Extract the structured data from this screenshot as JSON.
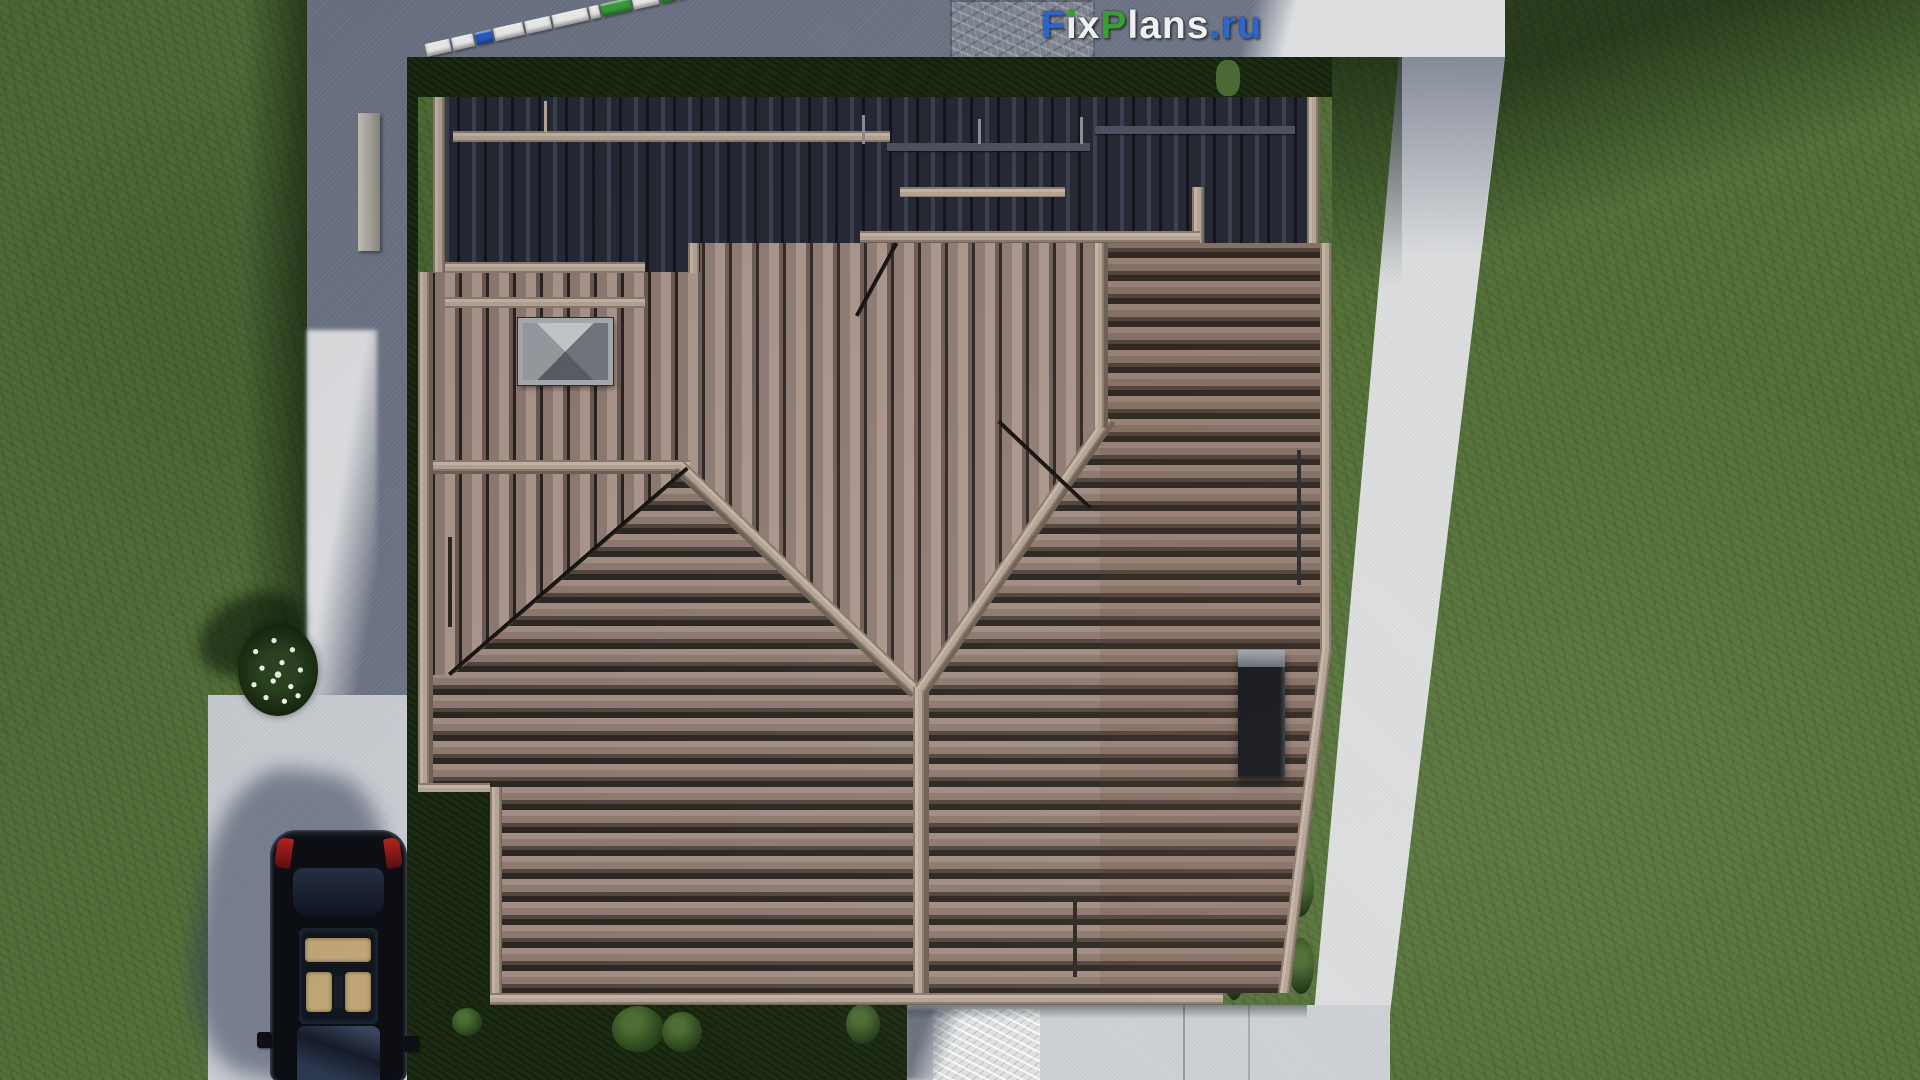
{
  "watermark": {
    "name": "FixPlans.ru",
    "parts": [
      {
        "text": "F",
        "color": "#2e66cf"
      },
      {
        "text": "i",
        "color": "#f2f3f5",
        "dot_color": "#3ba032"
      },
      {
        "text": "x",
        "color": "#f2f3f5"
      },
      {
        "text": "P",
        "color": "#3ba032"
      },
      {
        "text": "lans",
        "color": "#f2f3f5"
      },
      {
        "text": ".",
        "color": "#2e66cf"
      },
      {
        "text": "ru",
        "color": "#2e66cf"
      }
    ]
  },
  "scale_bar": {
    "segments": [
      {
        "color": "#f3f4f2",
        "width": 25
      },
      {
        "color": "#f3f4f2",
        "width": 22
      },
      {
        "color": "#2b5fc7",
        "width": 17
      },
      {
        "color": "#f3f4f2",
        "width": 30
      },
      {
        "color": "#f3f4f2",
        "width": 26
      },
      {
        "color": "#f3f4f2",
        "width": 36
      },
      {
        "color": "#f3f4f2",
        "width": 10
      },
      {
        "color": "#3aa33b",
        "width": 30
      },
      {
        "color": "#f3f4f2",
        "width": 26
      },
      {
        "color": "#3aa33b",
        "width": 15
      },
      {
        "color": "#2b5fc7",
        "width": 7
      }
    ]
  },
  "palette": {
    "grass_lit": "#55713a",
    "grass_shadow": "#1b2b11",
    "path_shadow": "#6f7687",
    "path_lit": "#dcdee0",
    "terrace": "#ced1d5",
    "roof_tiles_lit": "#8d7970",
    "roof_tiles_dark": "#252731",
    "ridge_trim": "#b4a496",
    "car_body": "#0c0e13",
    "car_seats": "#c0a676",
    "tail_light": "#b3231f"
  },
  "scene_objects": [
    "aerial house roof render",
    "concrete walkway frame",
    "driveway with parked car",
    "white flower bush",
    "roof skylight hatch",
    "chimney",
    "stone entrance walkway",
    "rear terrace"
  ]
}
